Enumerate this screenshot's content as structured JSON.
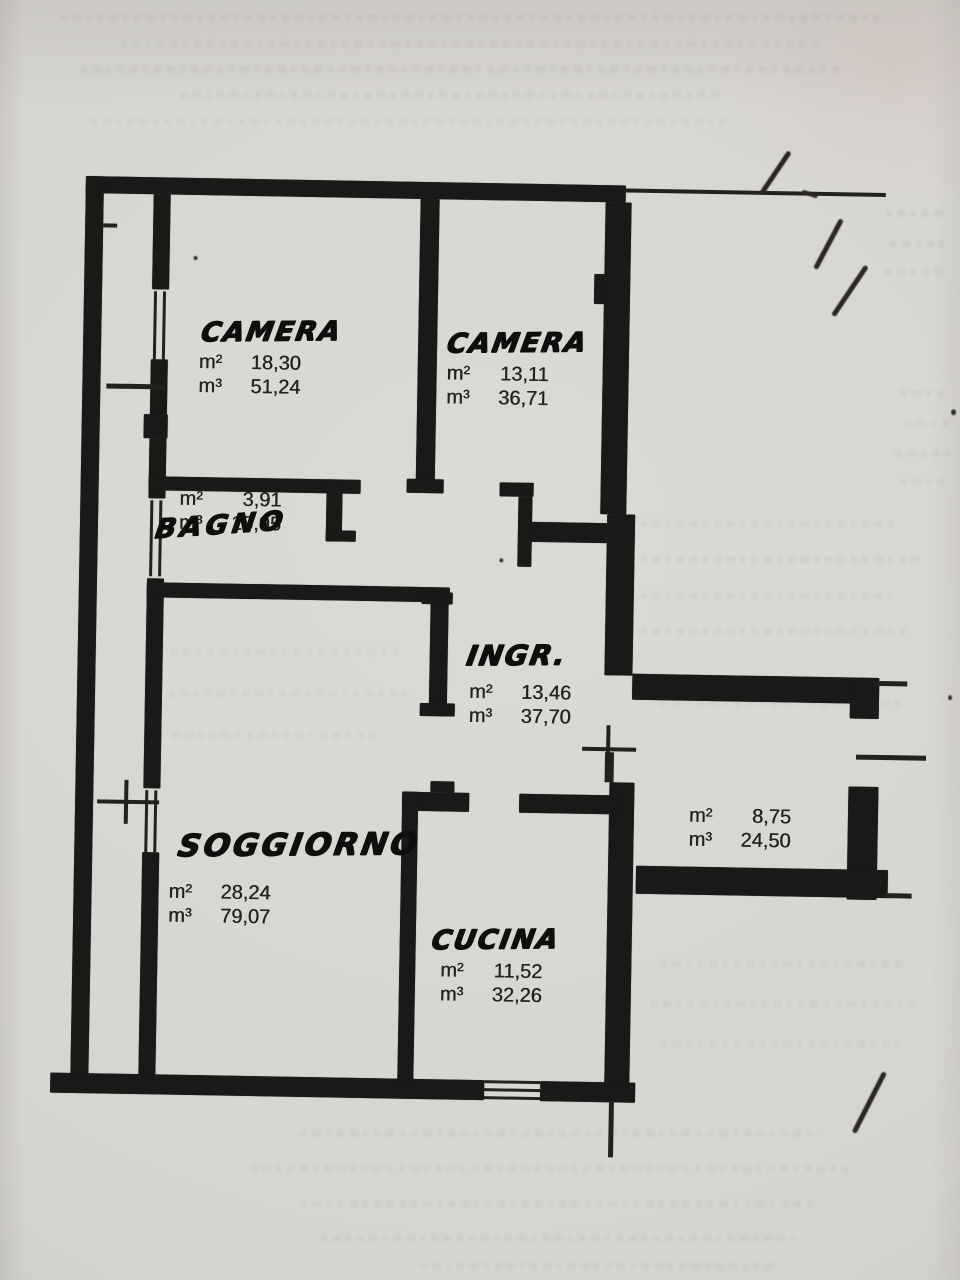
{
  "page": {
    "kind": "scanned apartment floor plan"
  },
  "units": {
    "area": "m²",
    "volume": "m³"
  },
  "rooms": [
    {
      "key": "camera-1",
      "name": "CAMERA",
      "area": "18,30",
      "volume": "51,24"
    },
    {
      "key": "camera-2",
      "name": "CAMERA",
      "area": "13,11",
      "volume": "36,71"
    },
    {
      "key": "bagno",
      "name": "BAGNO",
      "area": "3,91",
      "volume": "10,95"
    },
    {
      "key": "ingresso",
      "name": "INGR.",
      "area": "13,46",
      "volume": "37,70"
    },
    {
      "key": "soggiorno",
      "name": "SOGGIORNO",
      "area": "28,24",
      "volume": "79,07"
    },
    {
      "key": "cucina",
      "name": "CUCINA",
      "area": "11,52",
      "volume": "32,26"
    },
    {
      "key": "room-right",
      "name": "",
      "area": "8,75",
      "volume": "24,50"
    }
  ]
}
